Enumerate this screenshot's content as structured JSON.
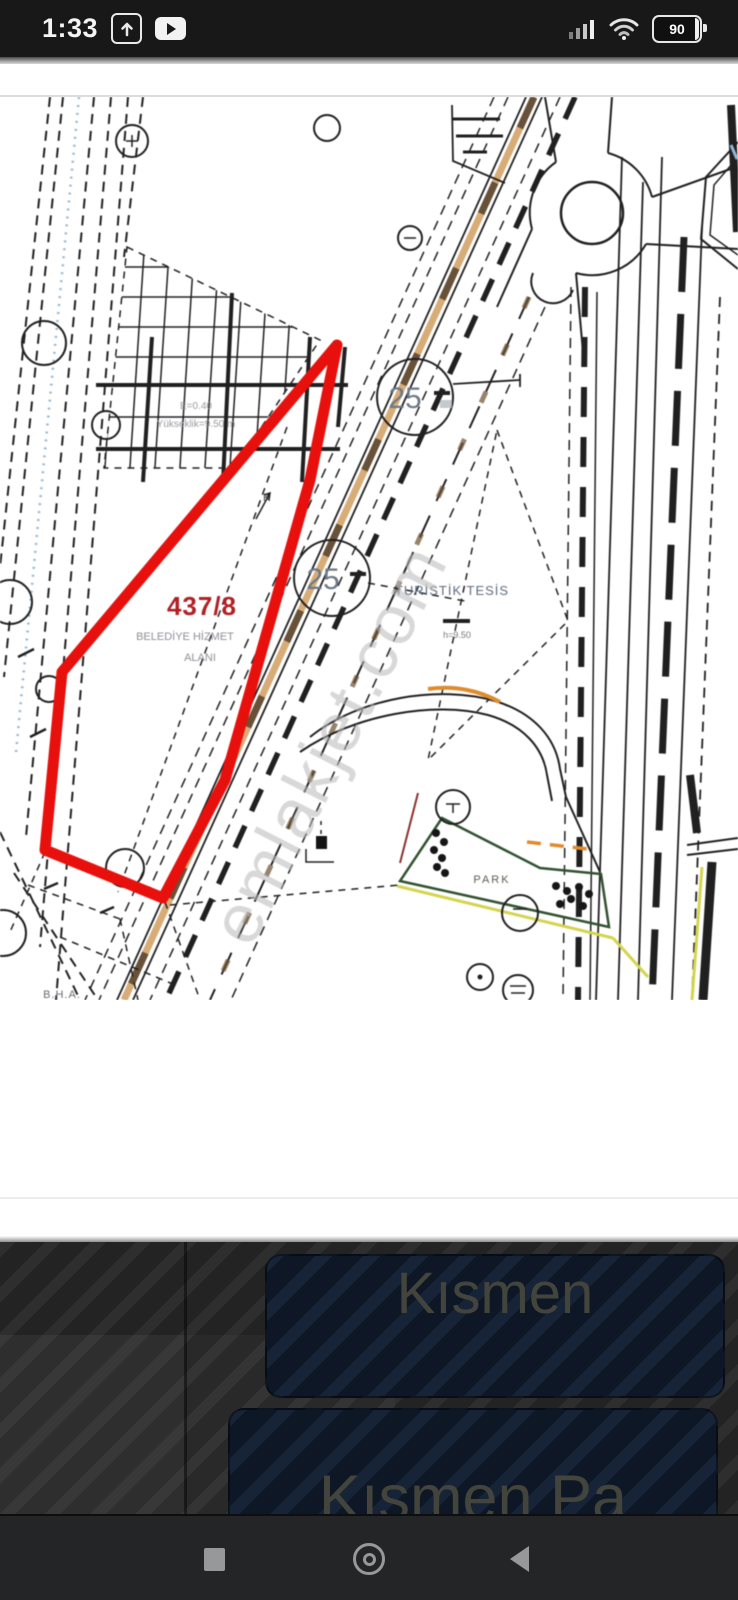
{
  "status_bar": {
    "time": "1:33",
    "battery_level": "90"
  },
  "map": {
    "parcel_number": "437/8",
    "parcel_use_line1": "BELEDİYE HİZMET",
    "parcel_use_line2": "ALANI",
    "zoning_note_line1": "E=0.40",
    "zoning_note_line2": "Yükseklik=9.50 m",
    "north_mark": "K",
    "road_width_label_1": "25",
    "road_width_label_2": "25",
    "facility_label": "TURİSTİK TESİS",
    "facility_note": "h=9.50",
    "park_label": "PARK",
    "area_abbrev": "B.H.A.",
    "watermark": "emlakjet.com"
  },
  "listing_panel": {
    "option_1": "Kısmen",
    "option_2": "Kısmen Pa"
  },
  "colors": {
    "parcel_outline": "#e8100c",
    "parcel_number_red": "#b02025",
    "road_tan": "#d8ac77",
    "road_orange": "#e08b2d",
    "park_green": "#31522f",
    "boundary_yellow": "#d4d44e",
    "boundary_blue": "#8fb8d6",
    "watermark_gray": "#b9b9b9",
    "panel_navy": "#0d1726",
    "panel_background": "#232323",
    "nav_icon_gray": "#96989a"
  }
}
